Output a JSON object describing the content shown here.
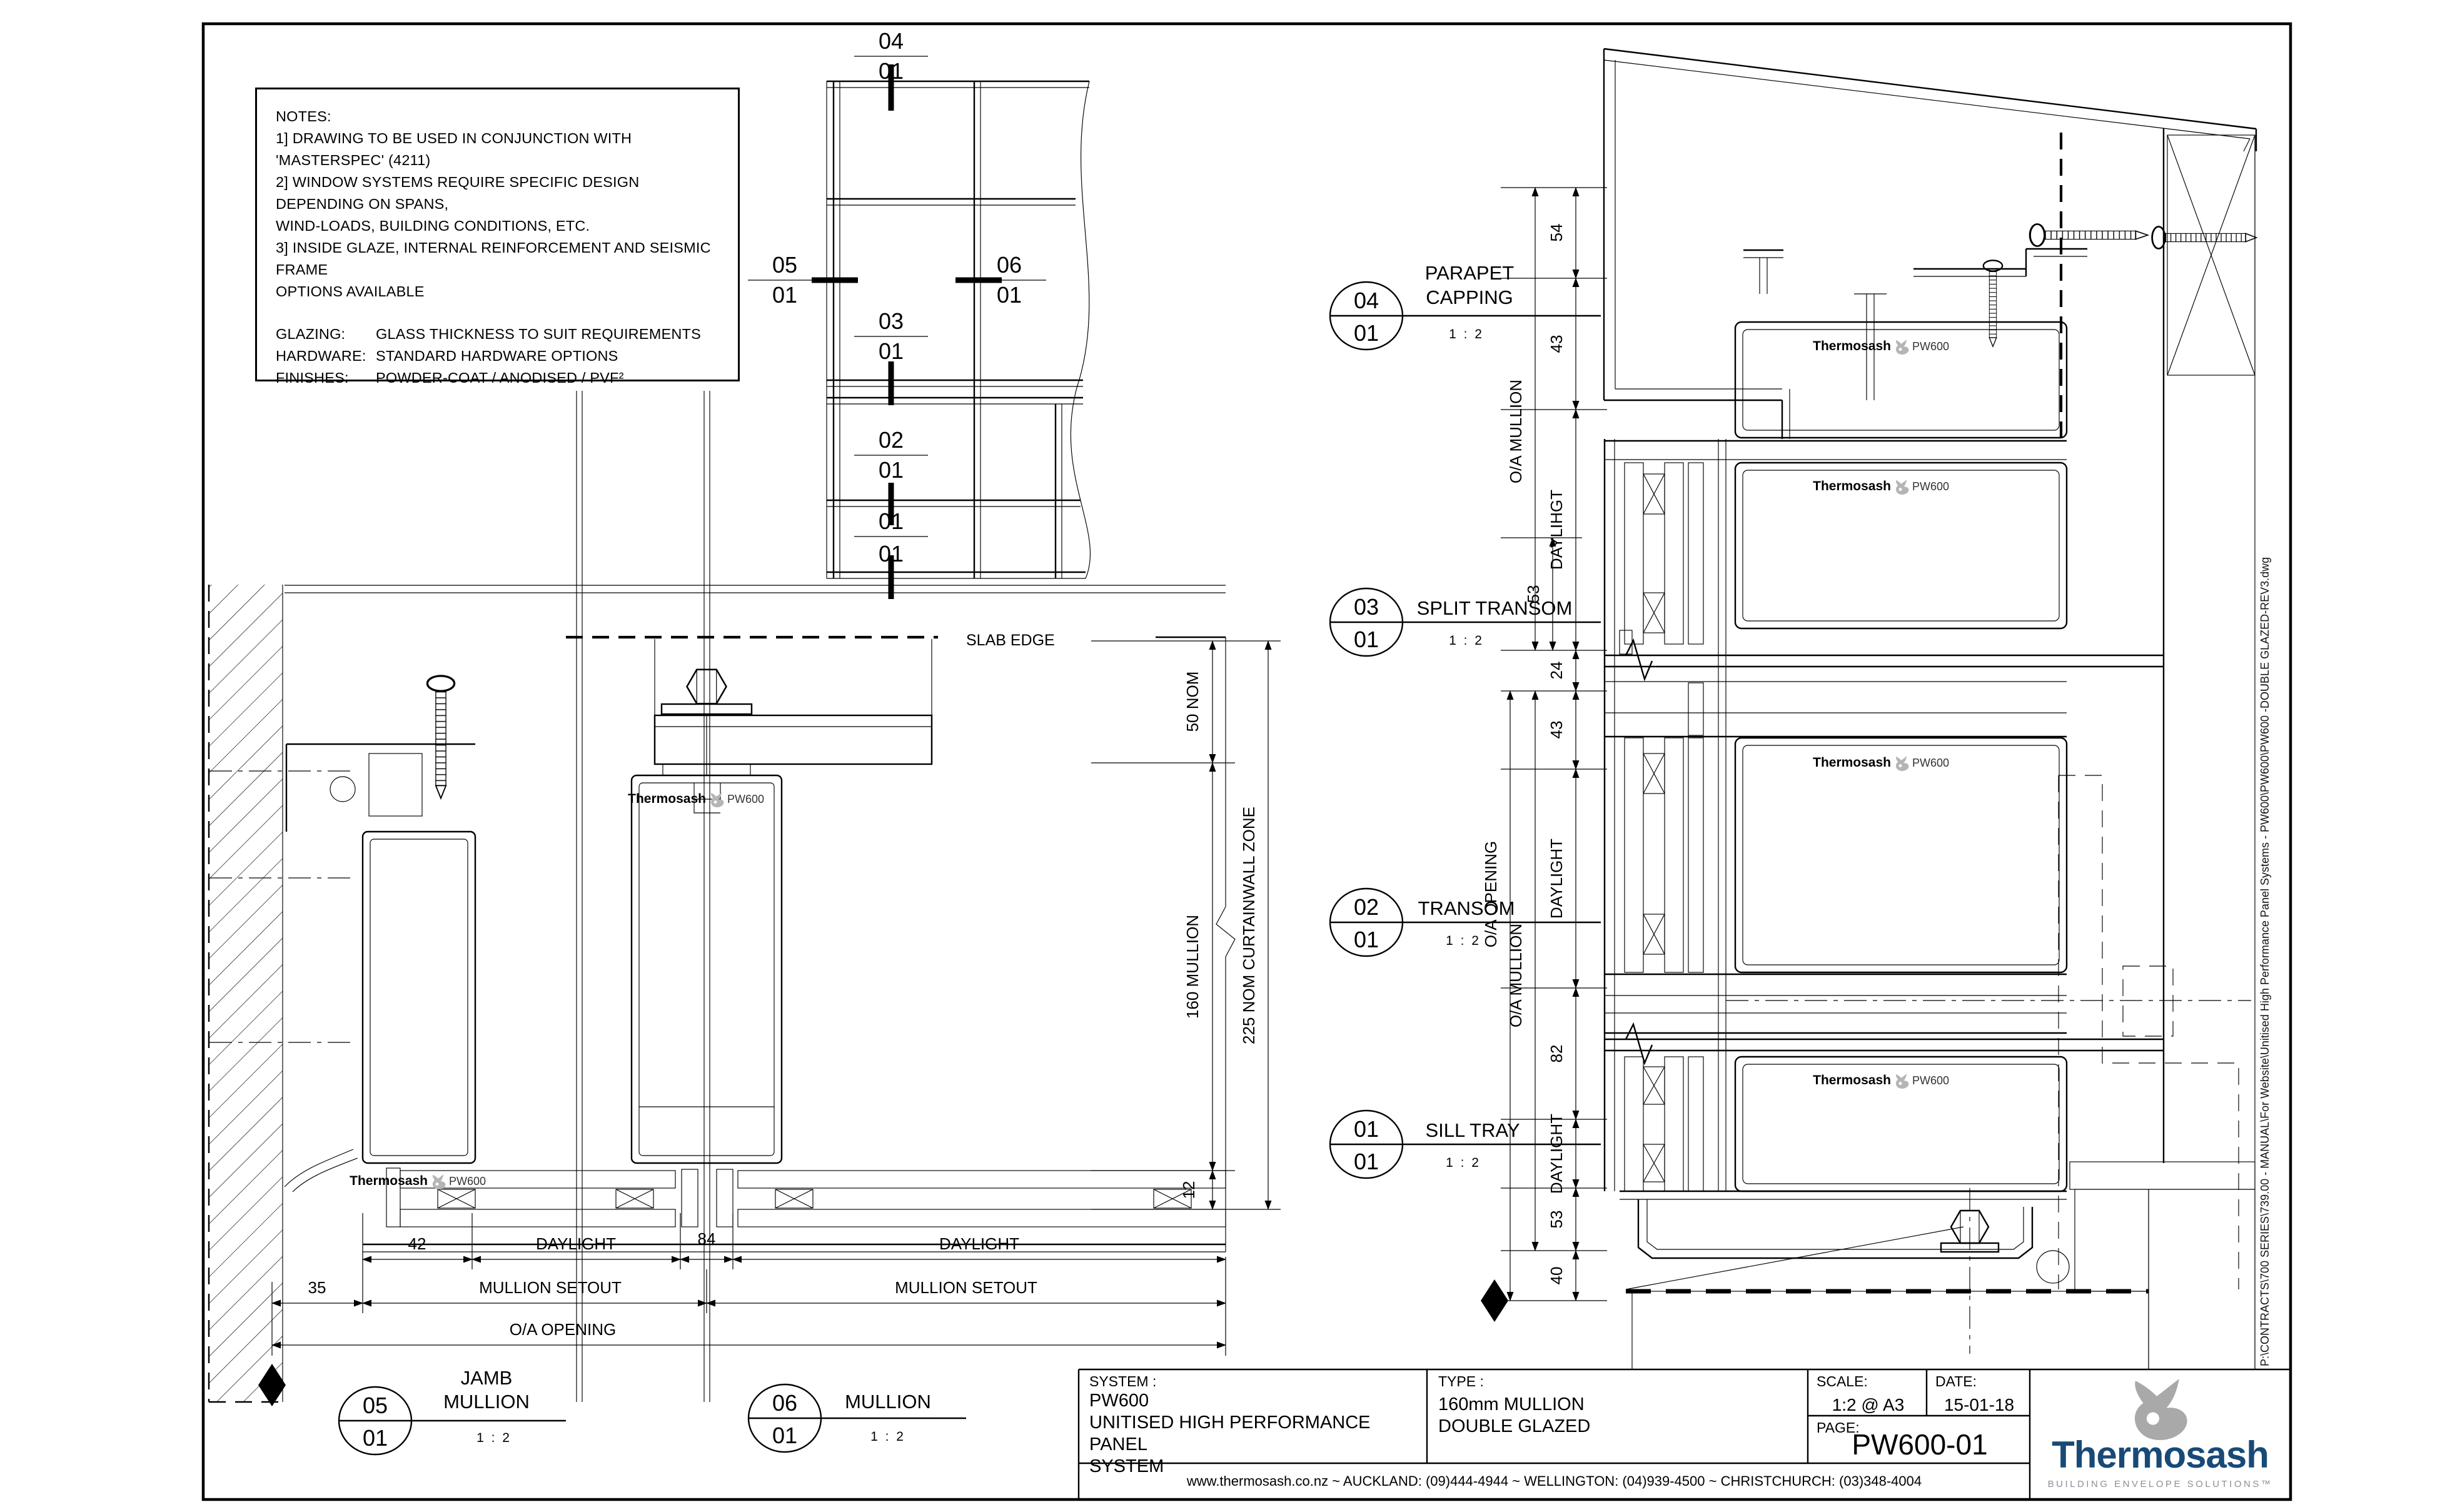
{
  "notes": {
    "heading": "NOTES:",
    "line1": "1] DRAWING TO BE USED IN CONJUNCTION WITH 'MASTERSPEC' (4211)",
    "line2": "2] WINDOW SYSTEMS REQUIRE SPECIFIC DESIGN DEPENDING ON SPANS,",
    "line3": "WIND-LOADS, BUILDING CONDITIONS, ETC.",
    "line4": "3] INSIDE GLAZE, INTERNAL REINFORCEMENT AND SEISMIC FRAME",
    "line5": "OPTIONS AVAILABLE",
    "glazing_label": "GLAZING:",
    "glazing_value": "GLASS THICKNESS TO SUIT REQUIREMENTS",
    "hardware_label": "HARDWARE:",
    "hardware_value": "STANDARD HARDWARE OPTIONS",
    "finishes_label": "FINISHES:",
    "finishes_value": "POWDER-COAT / ANODISED / PVF²"
  },
  "key_plan": {
    "k04": {
      "num": "04",
      "sheet": "01"
    },
    "k05": {
      "num": "05",
      "sheet": "01"
    },
    "k06": {
      "num": "06",
      "sheet": "01"
    },
    "k03": {
      "num": "03",
      "sheet": "01"
    },
    "k02": {
      "num": "02",
      "sheet": "01"
    },
    "k01": {
      "num": "01",
      "sheet": "01"
    }
  },
  "plan": {
    "slab_edge": "SLAB EDGE",
    "dim_50": "50 NOM",
    "dim_160": "160 MULLION",
    "dim_225": "225 NOM CURTAINWALL ZONE",
    "dim_12": "12",
    "dim_42": "42",
    "dim_84": "84",
    "dim_35": "35",
    "daylight_left": "DAYLIGHT",
    "daylight_right": "DAYLIGHT",
    "setout_left": "MULLION SETOUT",
    "setout_right": "MULLION SETOUT",
    "oa_opening": "O/A OPENING",
    "jamb_bubble": {
      "num": "05",
      "sheet": "01",
      "title1": "JAMB",
      "title2": "MULLION",
      "scale": "1 : 2"
    },
    "mullion_bubble": {
      "num": "06",
      "sheet": "01",
      "title": "MULLION",
      "scale": "1 : 2"
    }
  },
  "section": {
    "dims": {
      "d54": "54",
      "d43a": "43",
      "daylihgt": "DAYLIHGT",
      "d53a": "53",
      "d24": "24",
      "d43b": "43",
      "daylight_b": "DAYLIGHT",
      "d82": "82",
      "daylight_c": "DAYLIGHT",
      "d53b": "53",
      "d40": "40",
      "oa_mullion_upper": "O/A MULLION",
      "oa_mullion_lower": "O/A MULLION",
      "oa_opening": "O/A OPENING"
    },
    "details": [
      {
        "num": "04",
        "sheet": "01",
        "title1": "PARAPET",
        "title2": "CAPPING",
        "scale": "1 : 2"
      },
      {
        "num": "03",
        "sheet": "01",
        "title1": "SPLIT TRANSOM",
        "scale": "1 : 2"
      },
      {
        "num": "02",
        "sheet": "01",
        "title1": "TRANSOM",
        "scale": "1 : 2"
      },
      {
        "num": "01",
        "sheet": "01",
        "title1": "SILL TRAY",
        "scale": "1 : 2"
      }
    ]
  },
  "brand": {
    "name": "Thermosash",
    "product": "PW600"
  },
  "title_block": {
    "system_label": "SYSTEM :",
    "system_line1": "PW600",
    "system_line2": "UNITISED HIGH PERFORMANCE PANEL",
    "system_line3": "SYSTEM",
    "type_label": "TYPE :",
    "type_line1": "160mm MULLION",
    "type_line2": "DOUBLE GLAZED",
    "scale_label": "SCALE:",
    "scale_value": "1:2 @ A3",
    "date_label": "DATE:",
    "date_value": "15-01-18",
    "page_label": "PAGE:",
    "page_value": "PW600-01",
    "footer": "www.thermosash.co.nz  ~  AUCKLAND: (09)444-4944  ~  WELLINGTON: (04)939-4500  ~  CHRISTCHURCH: (03)348-4004",
    "logo_name": "Thermosash",
    "logo_tagline": "BUILDING ENVELOPE SOLUTIONS™",
    "logo_color": "#194a77",
    "logo_gray": "#a9a9a9"
  },
  "file_path": "P:\\CONTRACTS\\700 SERIES\\739.00 - MANUAL\\For Website\\Unitised High Performance Panel Systems - PW600\\PW600\\PW600 -DOUBLE GLAZED-REV3.dwg"
}
